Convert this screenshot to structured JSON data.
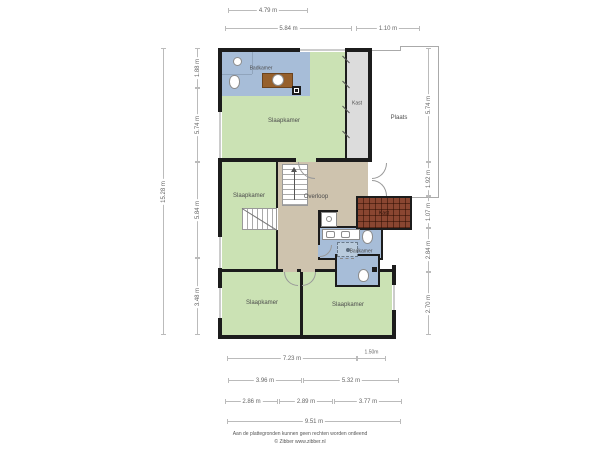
{
  "rooms": {
    "badkamer_top": "Badkamer",
    "slaapkamer_top": "Slaapkamer",
    "kast_strip": "Kast",
    "plaats": "Plaats",
    "slaapkamer_left": "Slaapkamer",
    "overloop": "Overloop",
    "kast_tiled": "Kast",
    "badkamer_mid": "Badkamer",
    "slaapkamer_bottom_left": "Slaapkamer",
    "slaapkamer_bottom_right": "Slaapkamer"
  },
  "dimensions": {
    "top": {
      "w1": "4.79 m",
      "w2": "5.84 m",
      "w3": "1.10 m"
    },
    "left": {
      "total": "15.28 m",
      "s1": "1.88 m",
      "s2": "5.74 m",
      "s3": "5.84 m",
      "s4": "3.48 m"
    },
    "right": {
      "s1": "5.74 m",
      "s2": "1.92 m",
      "s3": "1.07 m",
      "s4": "2.84 m",
      "s5": "2.70 m"
    },
    "bottom": {
      "r1a": "7.23 m",
      "r1b": "1.50m",
      "r2a": "3.96 m",
      "r2b": "5.32 m",
      "r3a": "2.86 m",
      "r3b": "2.89 m",
      "r3c": "3.77 m",
      "total": "9.51 m"
    }
  },
  "colors": {
    "room_green": "#cbe2b4",
    "room_blue": "#a7bdd8",
    "hall_tan": "#cec3ae",
    "closet_gray": "#dcdcdc",
    "tile_red": "#8a4631",
    "vanity_brown": "#96602c",
    "wall": "#1c1c1c"
  },
  "footer": {
    "line1": "Aan de plattegronden kunnen geen rechten worden ontleend",
    "line2": "© Zibber www.zibber.nl"
  }
}
